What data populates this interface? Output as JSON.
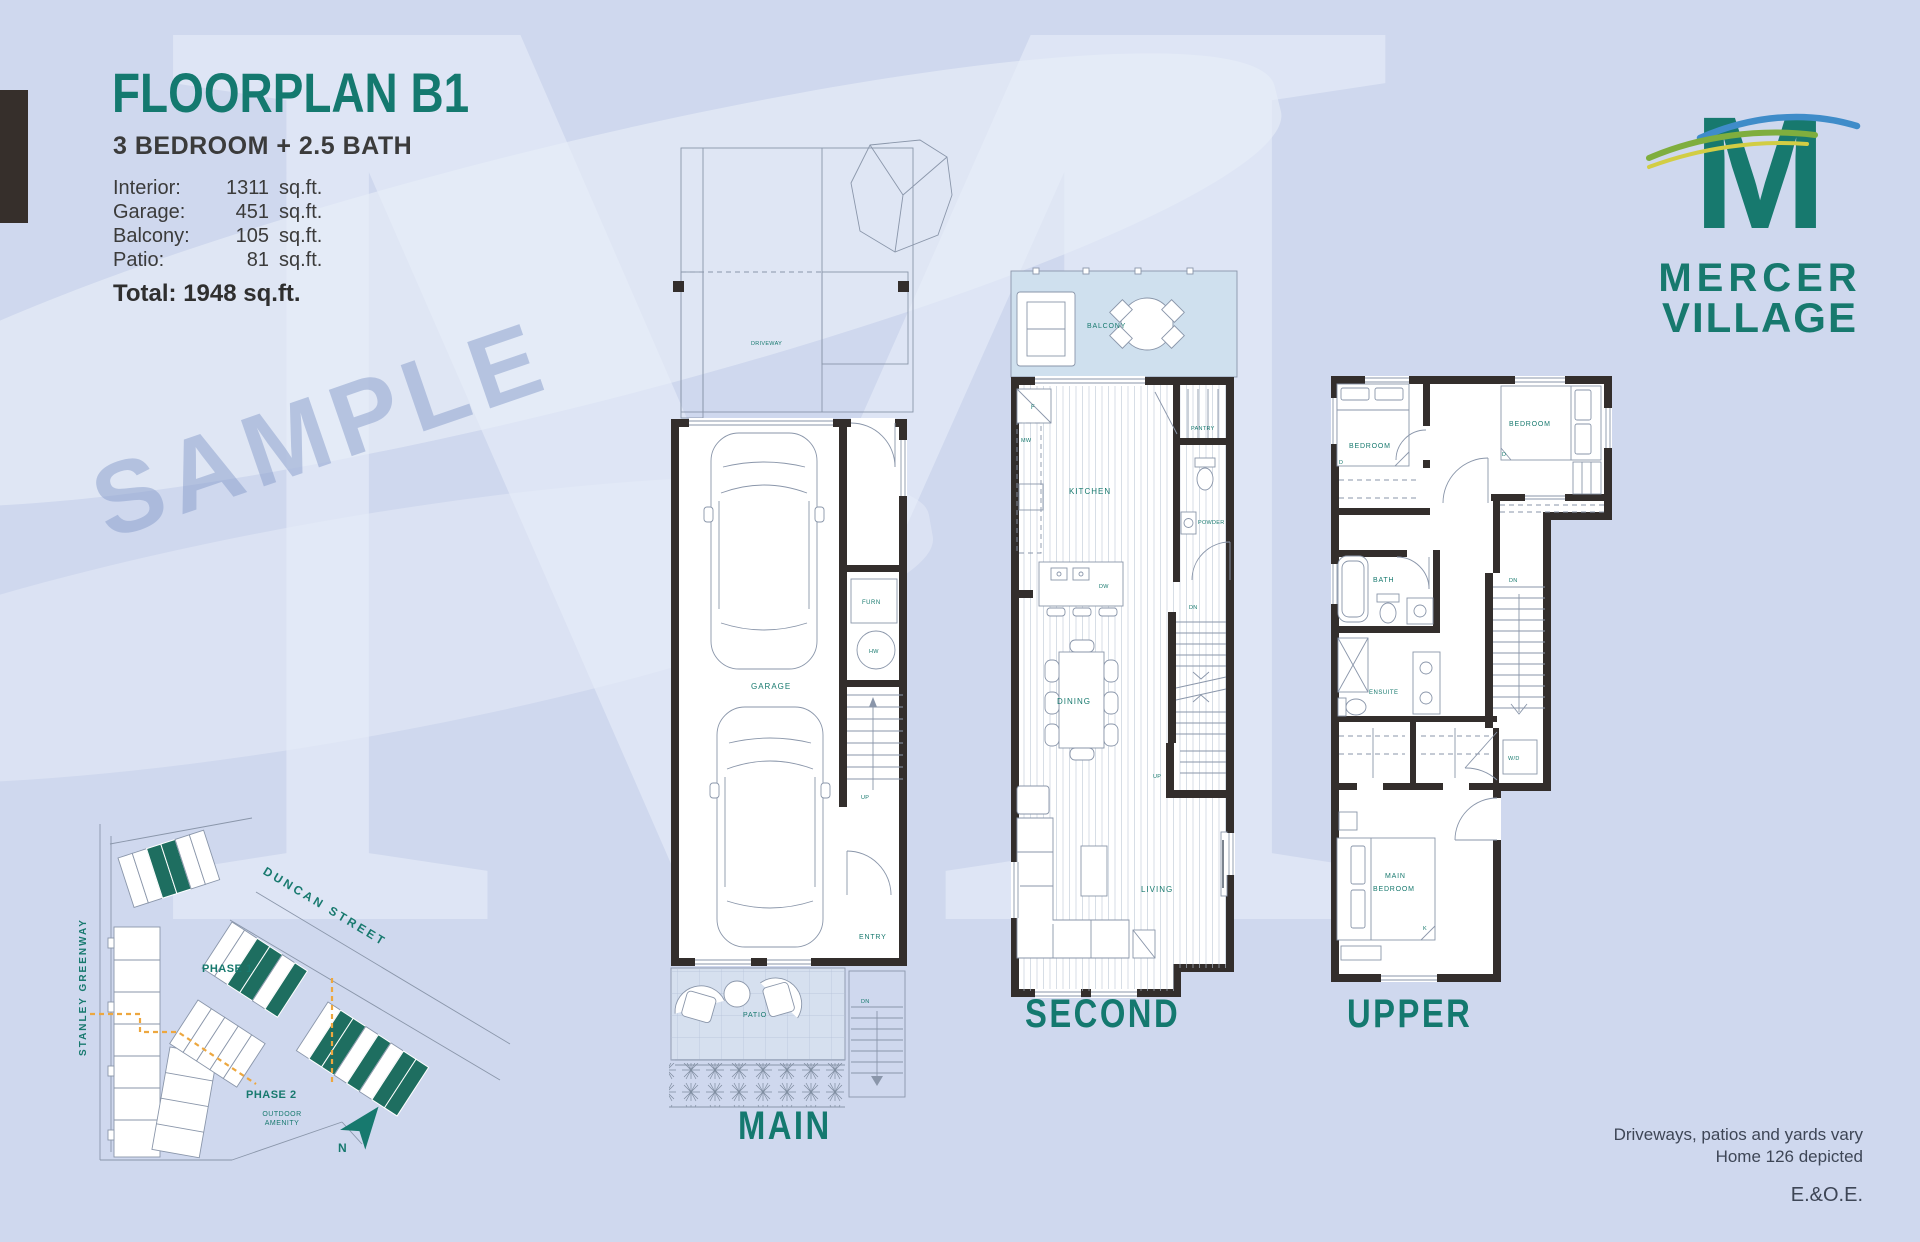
{
  "header": {
    "title": "FLOORPLAN B1",
    "subtitle": "3 BEDROOM + 2.5 BATH"
  },
  "stats": {
    "rows": [
      {
        "label": "Interior:",
        "value": "1311",
        "unit": "sq.ft."
      },
      {
        "label": "Garage:",
        "value": "451",
        "unit": "sq.ft."
      },
      {
        "label": "Balcony:",
        "value": "105",
        "unit": "sq.ft."
      },
      {
        "label": "Patio:",
        "value": "81",
        "unit": "sq.ft."
      }
    ],
    "total": "Total: 1948 sq.ft."
  },
  "logo": {
    "monogram": "M",
    "name_top": "MERCER",
    "name_bottom": "VILLAGE"
  },
  "watermark": {
    "sample": "SAMPLE",
    "ghost_letter": "M"
  },
  "plans": {
    "main": {
      "title": "MAIN",
      "labels": {
        "driveway": "DRIVEWAY",
        "garage": "GARAGE",
        "furn": "FURN",
        "hw": "HW",
        "up": "UP",
        "entry": "ENTRY",
        "patio": "PATIO",
        "dn": "DN"
      }
    },
    "second": {
      "title": "SECOND",
      "labels": {
        "balcony": "BALCONY",
        "f": "F",
        "mw": "MW",
        "kitchen": "KITCHEN",
        "pantry": "PANTRY",
        "powder": "POWDER",
        "dw": "DW",
        "dn": "DN",
        "up": "UP",
        "dining": "DINING",
        "living": "LIVING"
      }
    },
    "upper": {
      "title": "UPPER",
      "labels": {
        "bedroom": "BEDROOM",
        "d": "D",
        "bath": "BATH",
        "ensuite": "ENSUITE",
        "dn": "DN",
        "wd": "W/D",
        "main_1": "MAIN",
        "main_2": "BEDROOM",
        "k": "K"
      }
    }
  },
  "site_map": {
    "streets": {
      "stanley": "STANLEY GREENWAY",
      "duncan": "DUNCAN STREET"
    },
    "phase1": "PHASE 1",
    "phase2": "PHASE 2",
    "outdoor_1": "OUTDOOR",
    "outdoor_2": "AMENITY",
    "north": "N"
  },
  "footnotes": {
    "line1": "Driveways, patios and yards vary",
    "line2": "Home 126 depicted",
    "eoe": "E.&O.E."
  },
  "colors": {
    "teal": "#14796f",
    "wall": "#332e2c",
    "orange": "#e9a43c",
    "site_unit_teal": "#1e6e60",
    "background": "#cfd8ee"
  }
}
